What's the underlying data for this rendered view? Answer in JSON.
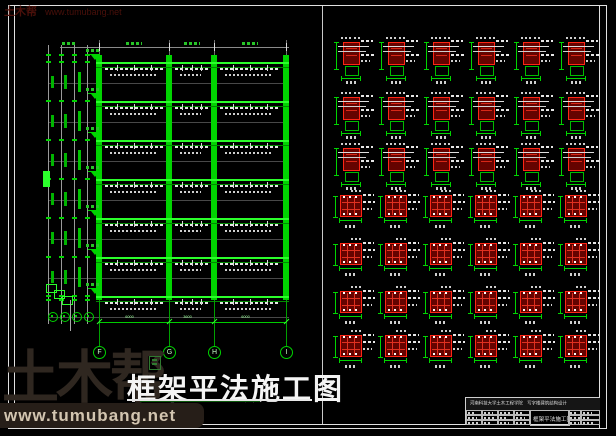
{
  "colors": {
    "background": "#000000",
    "green_line": "#00d400",
    "green_bright": "#2bff2b",
    "green_dim_text": "#9fff9f",
    "white_line": "#e8e8e8",
    "red_bright": "#ff2515",
    "red_dark_fill": "#650300",
    "logo_brown": "#2f2720",
    "logo_beige": "#d2c5b0",
    "watermark_dark_red": "#4a100a"
  },
  "watermark_top": {
    "brand": "土木帮",
    "site": "www.tumubang.net"
  },
  "watermark_bottom": {
    "brand": "土木帮",
    "site": "www.tumubang.net"
  },
  "main_title": {
    "text": "框架平法施工图"
  },
  "elevation": {
    "axis_labels": [
      "F",
      "G",
      "H",
      "I"
    ],
    "bay_dims": [
      "6000",
      "3600",
      "6000"
    ],
    "x_axes": [
      99,
      169,
      214,
      286
    ],
    "floors_y": [
      62,
      101,
      140,
      179,
      218,
      257,
      296
    ],
    "col_top": 55,
    "col_bottom": 300,
    "dim_line_y": 322,
    "bubble_y": 346,
    "left_chain_x": [
      48,
      61,
      74,
      87
    ]
  },
  "details_grid": {
    "cols_x": [
      333,
      378,
      423,
      468,
      513,
      558
    ],
    "rows": [
      {
        "y": 37,
        "type": "joint"
      },
      {
        "y": 92,
        "type": "joint"
      },
      {
        "y": 143,
        "type": "joint"
      },
      {
        "y": 192,
        "type": "section"
      },
      {
        "y": 240,
        "type": "section"
      },
      {
        "y": 288,
        "type": "section"
      },
      {
        "y": 332,
        "type": "section"
      }
    ]
  },
  "title_block": {
    "header": "河南科技大学土木工程学院　写字楼建筑结构设计",
    "drawing_name": "框架平法施工图"
  }
}
